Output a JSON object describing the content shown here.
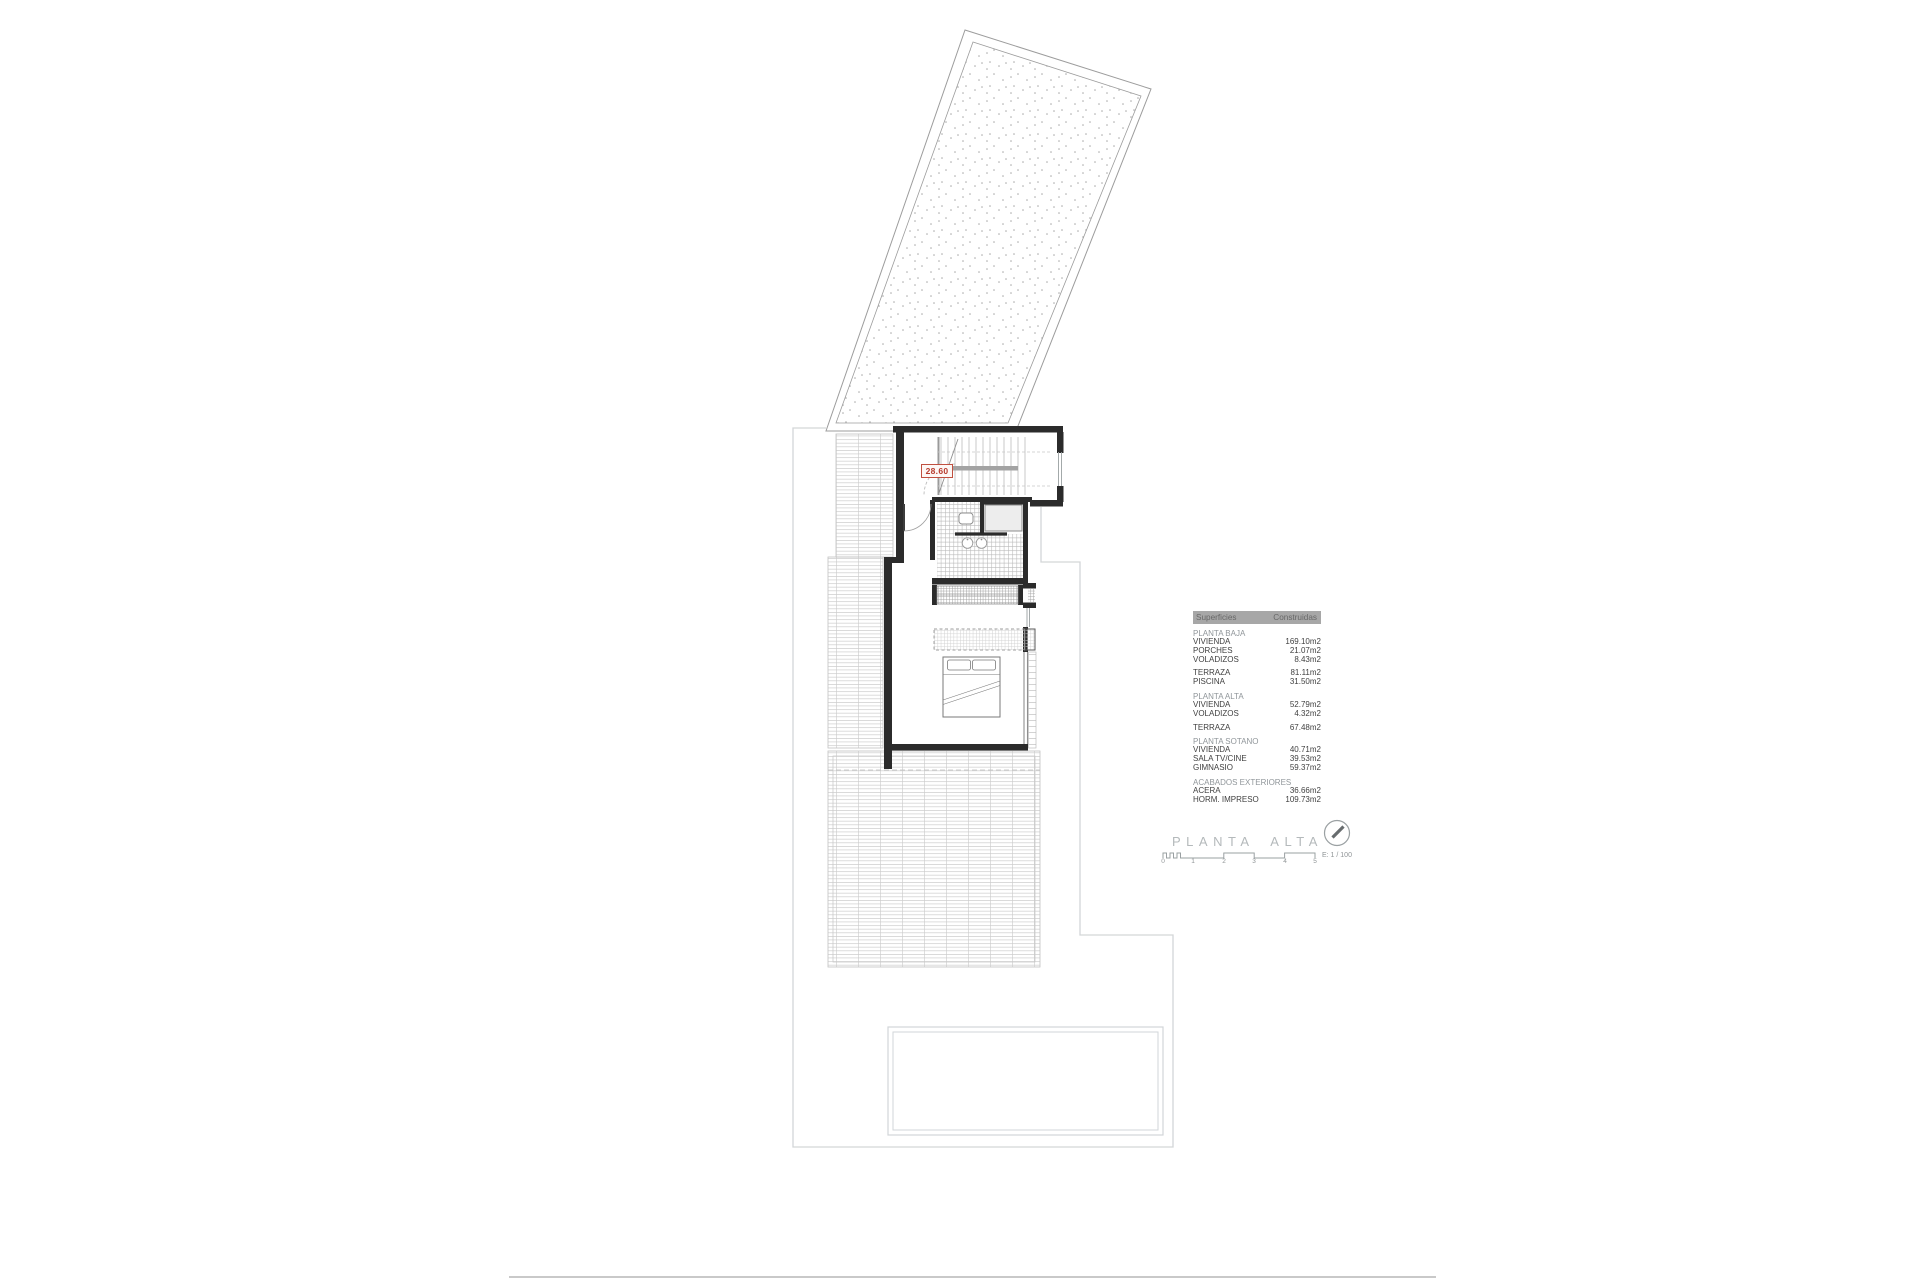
{
  "drawing": {
    "dimension_label": "28.60",
    "type_note": "upper floor plan of a villa with plot, terraces and pool"
  },
  "areas_table": {
    "header": {
      "col1": "Superficies",
      "col2": "Construidas"
    },
    "sections": [
      {
        "name": "PLANTA BAJA",
        "rows": [
          {
            "label": "VIVIENDA",
            "value": "169.10m2"
          },
          {
            "label": "PORCHES",
            "value": "21.07m2"
          },
          {
            "label": "VOLADIZOS",
            "value": "8.43m2"
          }
        ]
      },
      {
        "name": "",
        "rows": [
          {
            "label": "TERRAZA",
            "value": "81.11m2"
          },
          {
            "label": "PISCINA",
            "value": "31.50m2"
          }
        ]
      },
      {
        "name": "PLANTA ALTA",
        "rows": [
          {
            "label": "VIVIENDA",
            "value": "52.79m2"
          },
          {
            "label": "VOLADIZOS",
            "value": "4.32m2"
          }
        ]
      },
      {
        "name": "",
        "rows": [
          {
            "label": "TERRAZA",
            "value": "67.48m2"
          }
        ]
      },
      {
        "name": "PLANTA SOTANO",
        "rows": [
          {
            "label": "VIVIENDA",
            "value": "40.71m2"
          },
          {
            "label": "SALA TV/CINE",
            "value": "39.53m2"
          },
          {
            "label": "GIMNASIO",
            "value": "59.37m2"
          }
        ]
      },
      {
        "name": "ACABADOS EXTERIORES",
        "rows": [
          {
            "label": "ACERA",
            "value": "36.66m2"
          },
          {
            "label": "HORM. IMPRESO",
            "value": "109.73m2"
          }
        ]
      }
    ]
  },
  "title_block": {
    "title": "PLANTA ALTA",
    "scale_label": "E: 1 / 100",
    "scale_ticks": [
      "0",
      "1",
      "2",
      "3",
      "4",
      "5"
    ],
    "north_icon": "compass-needle-icon"
  },
  "colors": {
    "accent_red": "#b63a2c",
    "table_header_bg": "#a7a7a7",
    "wall_black": "#2b2b2b",
    "boundary_gray": "#d3d6d8",
    "hatch_gray": "#cbcbcb",
    "title_gray": "#b4b9bb"
  }
}
